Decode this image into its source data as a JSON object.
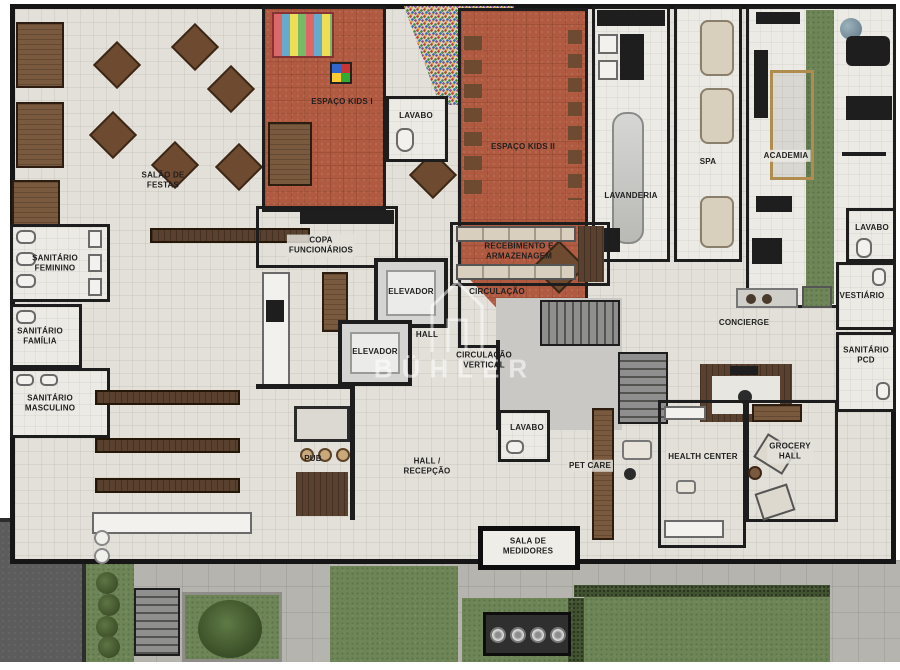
{
  "watermark": {
    "text": "BÜHLER",
    "icon": "house-outline-icon"
  },
  "palette": {
    "wall": "#1d1d1d",
    "floor": "#e3e0d9",
    "kids_terracotta": "#b05a42",
    "garden_green": "#6d8557",
    "hedge_green": "#41522f",
    "wood_brown": "#5a412f",
    "pavement_gray": "#b6b4af",
    "driveway_gray": "#5c5c5c",
    "watermark_white": "rgba(255,255,255,0.55)"
  },
  "rooms": [
    {
      "id": "salao-de-festas",
      "label": "SALÃO DE\nFESTAS"
    },
    {
      "id": "espaco-kids-1",
      "label": "ESPAÇO KIDS I"
    },
    {
      "id": "lavabo-kids",
      "label": "LAVABO"
    },
    {
      "id": "espaco-kids-2",
      "label": "ESPAÇO KIDS II"
    },
    {
      "id": "lavanderia",
      "label": "LAVANDERIA"
    },
    {
      "id": "spa",
      "label": "SPA"
    },
    {
      "id": "academia",
      "label": "ACADEMIA"
    },
    {
      "id": "lavabo-direita",
      "label": "LAVABO"
    },
    {
      "id": "vestiario",
      "label": "VESTIÁRIO"
    },
    {
      "id": "sanitario-feminino",
      "label": "SANITÁRIO\nFEMININO"
    },
    {
      "id": "sanitario-familia",
      "label": "SANITÁRIO\nFAMÍLIA"
    },
    {
      "id": "sanitario-masculino",
      "label": "SANITÁRIO\nMASCULINO"
    },
    {
      "id": "copa-funcionarios",
      "label": "COPA\nFUNCIONÁRIOS"
    },
    {
      "id": "elevador-1",
      "label": "ELEVADOR"
    },
    {
      "id": "elevador-2",
      "label": "ELEVADOR"
    },
    {
      "id": "recebimento",
      "label": "RECEBIMENTO E\nARMAZENAGEM"
    },
    {
      "id": "circulacao",
      "label": "CIRCULAÇÃO"
    },
    {
      "id": "hall",
      "label": "HALL"
    },
    {
      "id": "circulacao-vertical",
      "label": "CIRCULAÇÃO\nVERTICAL"
    },
    {
      "id": "concierge",
      "label": "CONCIERGE"
    },
    {
      "id": "sanitario-pcd",
      "label": "SANITÁRIO\nPCD"
    },
    {
      "id": "pub",
      "label": "PUB"
    },
    {
      "id": "hall-recepcao",
      "label": "HALL /\nRECEPÇÃO"
    },
    {
      "id": "lavabo-pet",
      "label": "LAVABO"
    },
    {
      "id": "pet-care",
      "label": "PET CARE"
    },
    {
      "id": "health-center",
      "label": "HEALTH CENTER"
    },
    {
      "id": "grocery-hall",
      "label": "GROCERY\nHALL"
    },
    {
      "id": "sala-de-medidores",
      "label": "SALA DE\nMEDIDORES"
    }
  ]
}
